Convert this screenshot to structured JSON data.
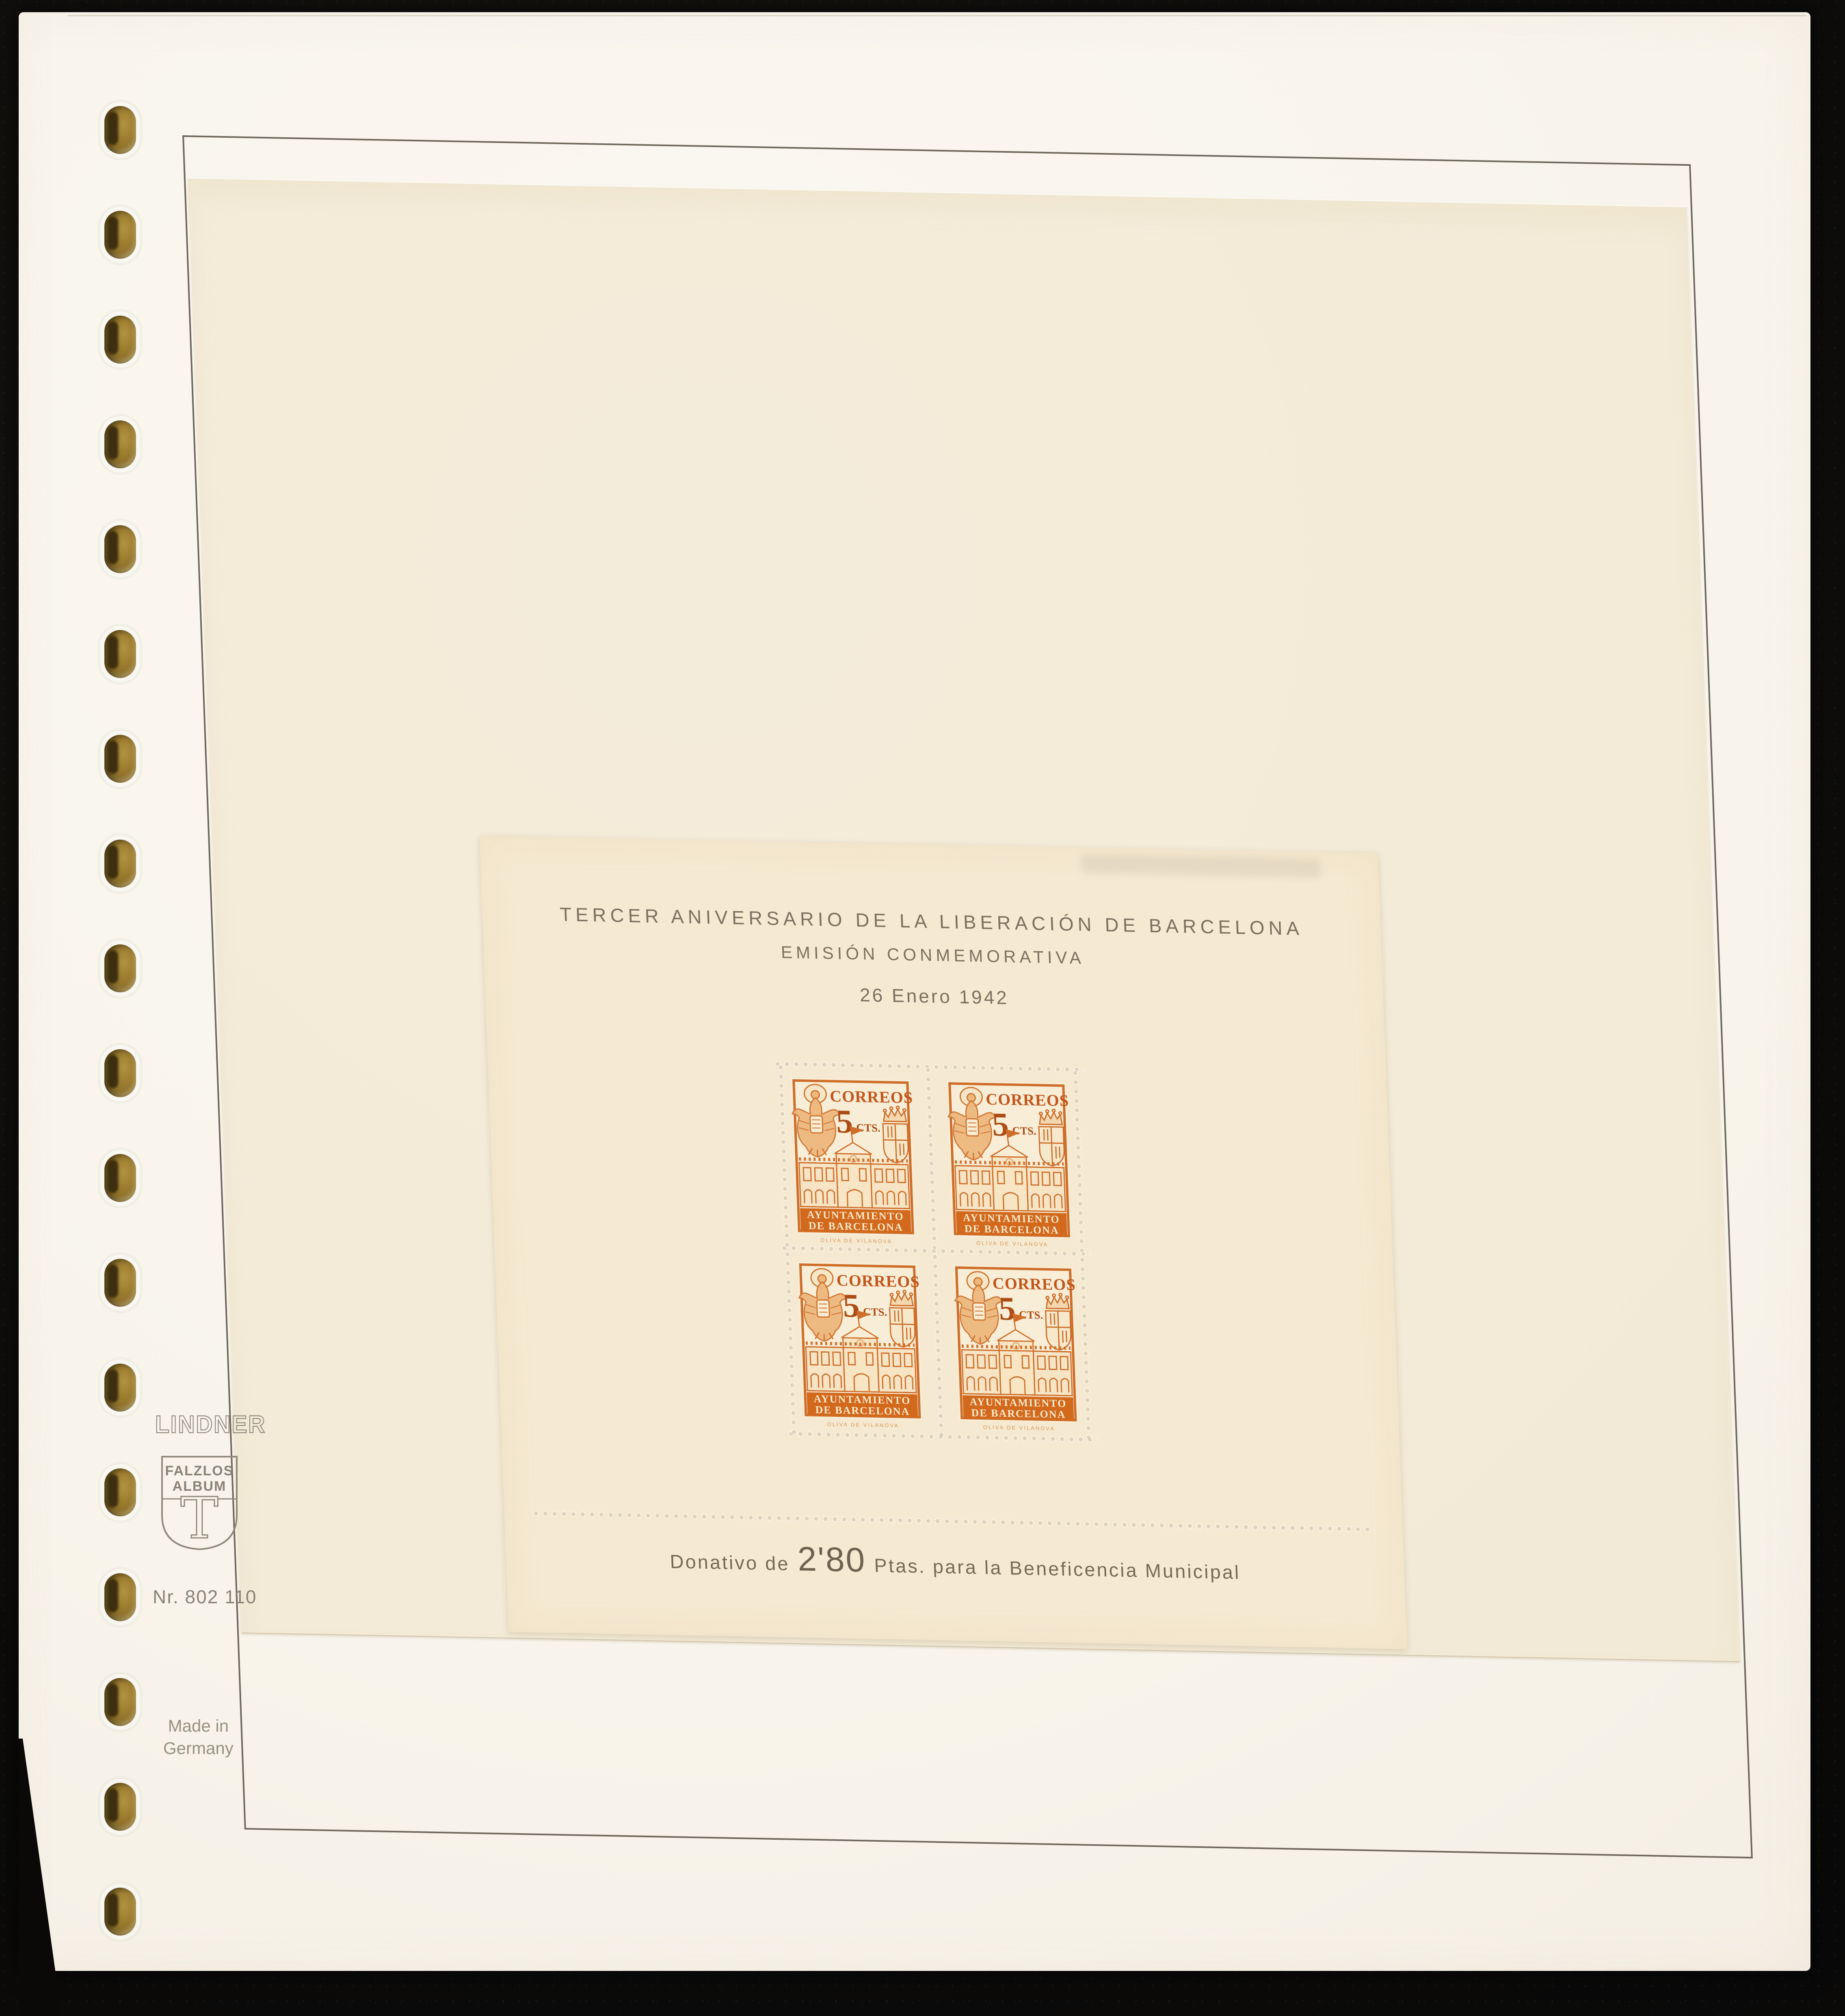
{
  "album_page": {
    "brand": "LINDNER",
    "shield_line1": "FALZLOS",
    "shield_line2": "ALBUM",
    "shield_letter": "T",
    "item_number": "Nr. 802 110",
    "origin_line1": "Made in",
    "origin_line2": "Germany",
    "binder_hole_count": 18
  },
  "sheet": {
    "title": "TERCER ANIVERSARIO DE LA LIBERACIÓN DE BARCELONA",
    "subtitle": "EMISIÓN CONMEMORATIVA",
    "date": "26 Enero 1942",
    "donation_prefix": "Donativo de",
    "donation_amount": "2'80",
    "donation_suffix": "Ptas. para la Beneficencia Municipal",
    "stamp_rows": 2,
    "stamp_cols": 2,
    "stamp": {
      "correos": "CORREOS",
      "value": "5",
      "value_unit": "CTS.",
      "banner_line1": "AYUNTAMIENTO",
      "banner_line2": "DE BARCELONA",
      "imprint": "OLIVA DE VILANOVA"
    }
  },
  "colors": {
    "stamp_orange": "#d0702c",
    "stamp_dark_orange": "#ad4d15",
    "banner_orange": "#d2691d",
    "sheet_cream": "#f5e9d1",
    "page_white": "#f7f3ea",
    "text_brown": "#7c7060",
    "brand_gray": "#8a8477",
    "eyelet_brass": "#9a7d33",
    "backdrop_black": "#0c0b0a"
  }
}
